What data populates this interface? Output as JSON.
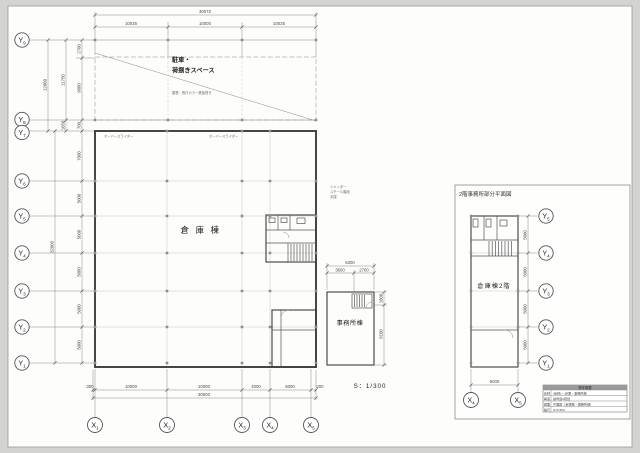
{
  "page": {
    "scale_label": "S：1/300"
  },
  "grid": {
    "x": "X",
    "y": "Y",
    "n1": "1",
    "n2": "2",
    "n3": "3",
    "n4": "4",
    "n5": "5",
    "n6": "6",
    "n7": "7",
    "n8": "8",
    "n9": "9"
  },
  "main": {
    "canopy_label_1": "駐車・",
    "canopy_label_2": "荷捌きスペース",
    "roof_note": "屋根：長尺カラー鉄板葺き",
    "warehouse_label": "倉庫棟",
    "office_label": "事務所棟",
    "overhead_door": "オーバースライダー",
    "note_1": "シャッター",
    "note_2": "スチール階段",
    "note_3": "手摺",
    "dims": {
      "top_total": "30070",
      "top_1": "10035",
      "top_2": "10000",
      "top_3": "10035",
      "left_outer": "12800",
      "left_inner": "11750",
      "seg_2700": "2700",
      "seg_9000": "9000",
      "seg_1050": "1050",
      "seg_700": "700",
      "left_total": "32000",
      "seg_7000": "7000",
      "bay": "5000",
      "bot_0": "300",
      "bot_1": "10000",
      "bot_2": "10000",
      "bot_3": "4000",
      "bot_4": "6000",
      "bot_5": "200",
      "bot_total": "30500",
      "office_total": "6300",
      "office_1": "3600",
      "office_2": "2700",
      "office_r1": "1800",
      "office_r2": "8100"
    }
  },
  "panel": {
    "title": "2階事務所部分平面図",
    "label": "倉庫棟2階",
    "dims": {
      "bay": "5000",
      "bottom": "6000"
    },
    "block": {
      "header": "物件概要",
      "r1c1": "名称",
      "r1c2": "(仮称)○○倉庫・事務所棟",
      "r2c1": "構造",
      "r2c2": "鉄骨造2階建",
      "r3c1": "図面",
      "r3c2": "平面図（倉庫棟・事務所棟）",
      "r4c1": "縮尺",
      "r4c2": "S=1/300"
    }
  }
}
